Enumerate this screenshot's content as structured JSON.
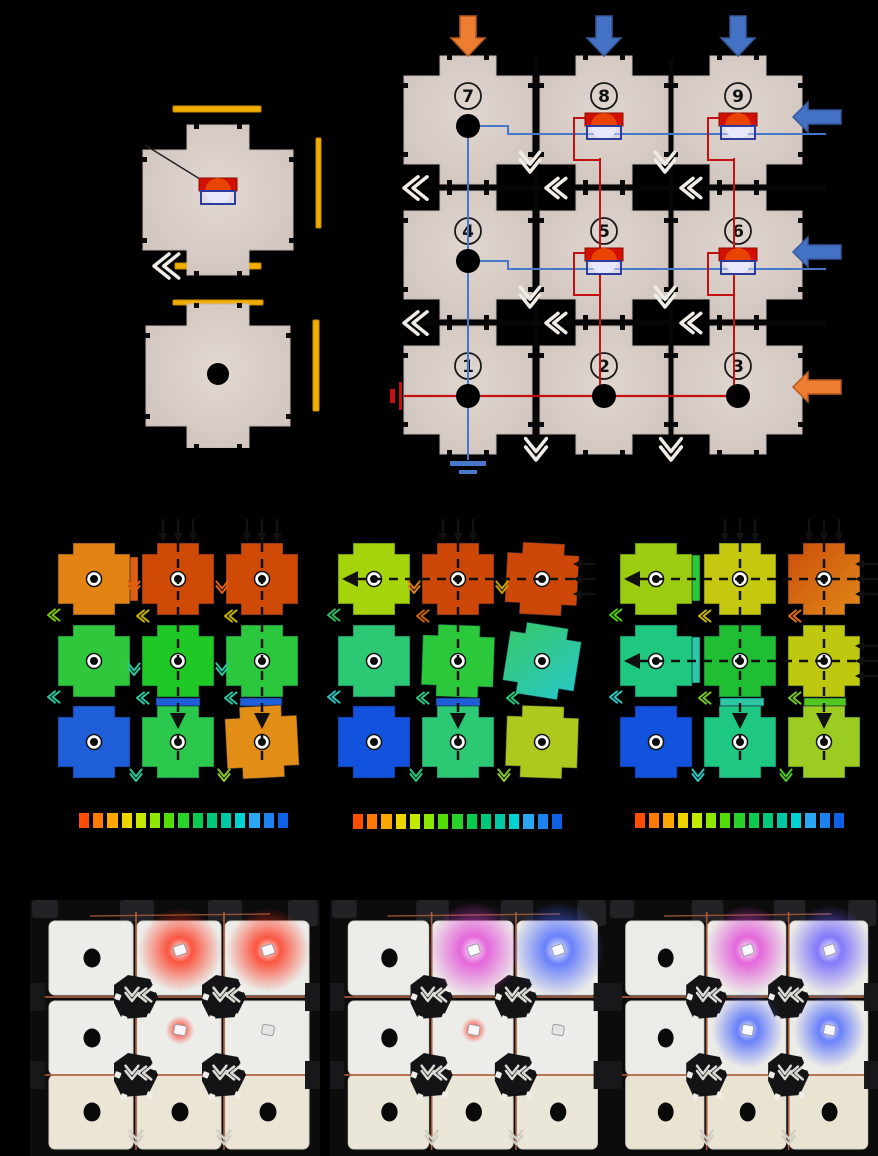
{
  "meta": {
    "background": "#000000",
    "figure_type": "multi-panel modular metamaterial figure"
  },
  "exploded_view": {
    "module_color": "#D8CEC8",
    "module_edge": "#C4B8B1",
    "copper_bar_color": "#F2AE00",
    "copper_bar_edge": "#C98E00",
    "pointer_line_color": "#222222",
    "led": {
      "body": "#D21000",
      "dome_top": "#E84400",
      "dome_bottom": "#E8E8FA",
      "socket_outline": "#2C3C9C"
    },
    "hole_color": "#000000",
    "chevron_color": "#F0ECE6",
    "bars": [
      {
        "x": 43,
        "y": 18,
        "w": 88,
        "h": 6
      },
      {
        "x": 186,
        "y": 50,
        "w": 5,
        "h": 90
      },
      {
        "x": 45,
        "y": 175,
        "w": 86,
        "h": 6
      },
      {
        "x": 43,
        "y": 212,
        "w": 90,
        "h": 5
      },
      {
        "x": 183,
        "y": 232,
        "w": 6,
        "h": 91
      }
    ],
    "modules": [
      {
        "cx": 88,
        "cy": 112,
        "has_led": true
      },
      {
        "cx": 88,
        "cy": 288,
        "has_hole": true
      }
    ]
  },
  "circuit_panel": {
    "module_color": "#D8CEC8",
    "power_wire_color": "#C41010",
    "ground_wire_color": "#4677C8",
    "rod_color": "#060606",
    "chevron_color": "#F0ECE6",
    "arrow_colors": {
      "orange": "#ED7D31",
      "orange_edge": "#B85C1E",
      "blue": "#4472C4",
      "blue_edge": "#35599A"
    },
    "cols": [
      80,
      216,
      350
    ],
    "rows": [
      112,
      247,
      382
    ],
    "modules": [
      {
        "num": "7",
        "row": 0,
        "col": 0,
        "element": "hole"
      },
      {
        "num": "8",
        "row": 0,
        "col": 1,
        "element": "led"
      },
      {
        "num": "9",
        "row": 0,
        "col": 2,
        "element": "led"
      },
      {
        "num": "4",
        "row": 1,
        "col": 0,
        "element": "hole"
      },
      {
        "num": "5",
        "row": 1,
        "col": 1,
        "element": "led"
      },
      {
        "num": "6",
        "row": 1,
        "col": 2,
        "element": "led"
      },
      {
        "num": "1",
        "row": 2,
        "col": 0,
        "element": "hole"
      },
      {
        "num": "2",
        "row": 2,
        "col": 1,
        "element": "hole"
      },
      {
        "num": "3",
        "row": 2,
        "col": 2,
        "element": "hole"
      }
    ],
    "top_input_arrows": [
      "orange",
      "blue",
      "blue"
    ],
    "right_input_arrows": [
      "blue",
      "blue",
      "orange"
    ],
    "has_power_supply_symbol": true,
    "has_ground_symbol": true
  },
  "fea_panels": [
    {
      "cells": [
        [
          "#E28313",
          "#CF4A07",
          "#CF4A07"
        ],
        [
          "#2FC83C",
          "#1FC825",
          "#2BC83E"
        ],
        [
          "#1E5ED8",
          "#2CC84E",
          "#E28E16"
        ]
      ],
      "rots": [
        [
          0,
          0,
          0
        ],
        [
          0,
          0,
          0
        ],
        [
          0,
          0,
          -3
        ]
      ],
      "grads": [],
      "vdash": [
        1,
        2
      ],
      "hdash": [],
      "top_loads": [
        1,
        2
      ],
      "right_loads": [],
      "strips": [
        {
          "x": 90,
          "y": 42,
          "w": 8,
          "h": 44,
          "c": "#E06010"
        },
        {
          "x": 116,
          "y": 183,
          "w": 44,
          "h": 8,
          "c": "#1E5ED8"
        },
        {
          "x": 200,
          "y": 183,
          "w": 42,
          "h": 8,
          "c": "#1E5ED8"
        }
      ],
      "chevrons": [
        {
          "x": 8,
          "y": 100,
          "d": "l",
          "c": "#7CC800"
        },
        {
          "x": 97,
          "y": 101,
          "d": "l",
          "c": "#C8B400"
        },
        {
          "x": 185,
          "y": 101,
          "d": "l",
          "c": "#C8B400"
        },
        {
          "x": 94,
          "y": 78,
          "d": "d",
          "c": "#E06010"
        },
        {
          "x": 182,
          "y": 78,
          "d": "d",
          "c": "#E06010"
        },
        {
          "x": 8,
          "y": 182,
          "d": "l",
          "c": "#28C8A0"
        },
        {
          "x": 97,
          "y": 183,
          "d": "l",
          "c": "#28C8A0"
        },
        {
          "x": 185,
          "y": 183,
          "d": "l",
          "c": "#28C8A0"
        },
        {
          "x": 94,
          "y": 160,
          "d": "d",
          "c": "#28C8A0"
        },
        {
          "x": 182,
          "y": 160,
          "d": "d",
          "c": "#28C8A0"
        },
        {
          "x": 96,
          "y": 266,
          "d": "d",
          "c": "#28C8A0"
        },
        {
          "x": 184,
          "y": 266,
          "d": "d",
          "c": "#8CC828"
        }
      ]
    },
    {
      "cells": [
        [
          "#A6D40C",
          "#CC4708",
          "#CC4708"
        ],
        [
          "#2CC874",
          "#2CC83C",
          "#38C868"
        ],
        [
          "#1252DC",
          "#2CC874",
          "#AFC81E"
        ]
      ],
      "rots": [
        [
          0,
          0,
          3
        ],
        [
          0,
          2,
          9
        ],
        [
          0,
          0,
          2
        ]
      ],
      "grads": [
        {
          "r": 1,
          "c": 2,
          "c2": "#28C8C8"
        }
      ],
      "vdash": [
        1
      ],
      "hdash": [
        0
      ],
      "top_loads": [
        1
      ],
      "right_loads": [
        0
      ],
      "strips": [
        {
          "x": 116,
          "y": 183,
          "w": 44,
          "h": 8,
          "c": "#1E5ED8"
        }
      ],
      "chevrons": [
        {
          "x": 94,
          "y": 78,
          "d": "d",
          "c": "#E08010"
        },
        {
          "x": 182,
          "y": 78,
          "d": "d",
          "c": "#C8A000"
        },
        {
          "x": 8,
          "y": 100,
          "d": "l",
          "c": "#30B860"
        },
        {
          "x": 97,
          "y": 101,
          "d": "l",
          "c": "#C86400"
        },
        {
          "x": 8,
          "y": 182,
          "d": "l",
          "c": "#28C8C0"
        },
        {
          "x": 97,
          "y": 183,
          "d": "l",
          "c": "#28C880"
        },
        {
          "x": 187,
          "y": 183,
          "d": "l",
          "c": "#28C880"
        },
        {
          "x": 96,
          "y": 266,
          "d": "d",
          "c": "#28C880"
        },
        {
          "x": 184,
          "y": 266,
          "d": "d",
          "c": "#8CC828"
        }
      ]
    },
    {
      "cells": [
        [
          "#9CCC10",
          "#C6C80F",
          "#CC4E0B"
        ],
        [
          "#1EC87E",
          "#1FBE33",
          "#BDC80F"
        ],
        [
          "#1252DC",
          "#1EC882",
          "#9CCC22"
        ]
      ],
      "rots": [
        [
          0,
          0,
          0
        ],
        [
          0,
          0,
          0
        ],
        [
          0,
          0,
          0
        ]
      ],
      "grads": [
        {
          "r": 0,
          "c": 2,
          "c2": "#E08818"
        }
      ],
      "vdash": [
        1,
        2
      ],
      "hdash": [
        0,
        1
      ],
      "top_loads": [
        1,
        2
      ],
      "right_loads": [
        0,
        1
      ],
      "strips": [
        {
          "x": 90,
          "y": 40,
          "w": 8,
          "h": 46,
          "c": "#2CC83C"
        },
        {
          "x": 90,
          "y": 122,
          "w": 8,
          "h": 46,
          "c": "#2CC8A8"
        },
        {
          "x": 118,
          "y": 183,
          "w": 44,
          "h": 8,
          "c": "#2CC8A8"
        },
        {
          "x": 202,
          "y": 183,
          "w": 42,
          "h": 8,
          "c": "#50C81E"
        }
      ],
      "chevrons": [
        {
          "x": 8,
          "y": 100,
          "d": "l",
          "c": "#50C800"
        },
        {
          "x": 97,
          "y": 101,
          "d": "l",
          "c": "#C8B400"
        },
        {
          "x": 187,
          "y": 101,
          "d": "l",
          "c": "#E07010"
        },
        {
          "x": 8,
          "y": 182,
          "d": "l",
          "c": "#28C8C0"
        },
        {
          "x": 97,
          "y": 183,
          "d": "l",
          "c": "#78C828"
        },
        {
          "x": 187,
          "y": 183,
          "d": "l",
          "c": "#78C828"
        },
        {
          "x": 96,
          "y": 266,
          "d": "d",
          "c": "#28C8C0"
        },
        {
          "x": 184,
          "y": 266,
          "d": "d",
          "c": "#50C828"
        }
      ]
    }
  ],
  "fea_layout": {
    "cols": [
      54,
      138,
      222
    ],
    "rows": [
      64,
      146,
      227
    ],
    "dash_color": "#101010",
    "load_arrow_color": "#111111"
  },
  "colorbar": {
    "colors": [
      "#FF4E00",
      "#FF7A00",
      "#FFA600",
      "#EED500",
      "#C4E800",
      "#8CE800",
      "#52DC08",
      "#28D228",
      "#0ACB4E",
      "#00C87A",
      "#00C8A6",
      "#00D2D2",
      "#2BA6F2",
      "#1E82EE",
      "#1060E6"
    ]
  },
  "photo_panels": [
    {
      "module_fill_top": "#ECECE8",
      "module_fill_bottom": "#EAE5D4",
      "copper_color": "#AE5E3C",
      "holes": [
        [
          0,
          0
        ],
        [
          1,
          0
        ],
        [
          2,
          0
        ],
        [
          2,
          1
        ],
        [
          2,
          2
        ]
      ],
      "leds": [
        {
          "row": 0,
          "col": 1,
          "color": "#FF3018",
          "glow": 26
        },
        {
          "row": 0,
          "col": 2,
          "color": "#FF3018",
          "glow": 26
        },
        {
          "row": 1,
          "col": 1,
          "color": "#FF4030",
          "glow": 9
        },
        {
          "row": 1,
          "col": 2,
          "color": null,
          "glow": 0
        }
      ]
    },
    {
      "module_fill_top": "#ECECE8",
      "module_fill_bottom": "#EAE6D8",
      "copper_color": "#AE5E3C",
      "holes": [
        [
          0,
          0
        ],
        [
          1,
          0
        ],
        [
          2,
          0
        ],
        [
          2,
          1
        ],
        [
          2,
          2
        ]
      ],
      "leds": [
        {
          "row": 0,
          "col": 1,
          "color": "#E246D8",
          "glow": 30
        },
        {
          "row": 0,
          "col": 2,
          "color": "#4A66FF",
          "glow": 30
        },
        {
          "row": 1,
          "col": 1,
          "color": "#FF4030",
          "glow": 8
        },
        {
          "row": 1,
          "col": 2,
          "color": null,
          "glow": 0
        }
      ]
    },
    {
      "module_fill_top": "#EBEBE7",
      "module_fill_bottom": "#E9E4D2",
      "copper_color": "#AE5E3C",
      "holes": [
        [
          0,
          0
        ],
        [
          1,
          0
        ],
        [
          2,
          0
        ],
        [
          2,
          1
        ],
        [
          2,
          2
        ]
      ],
      "leds": [
        {
          "row": 0,
          "col": 1,
          "color": "#E246D8",
          "glow": 28
        },
        {
          "row": 0,
          "col": 2,
          "color": "#6A5CFF",
          "glow": 28
        },
        {
          "row": 1,
          "col": 1,
          "color": "#4A66FF",
          "glow": 24
        },
        {
          "row": 1,
          "col": 2,
          "color": "#4A66FF",
          "glow": 24
        }
      ]
    }
  ],
  "photo_layout": {
    "cols": [
      62,
      150,
      238
    ],
    "rows": [
      58,
      138,
      212
    ],
    "background": "#0C0C0C"
  }
}
